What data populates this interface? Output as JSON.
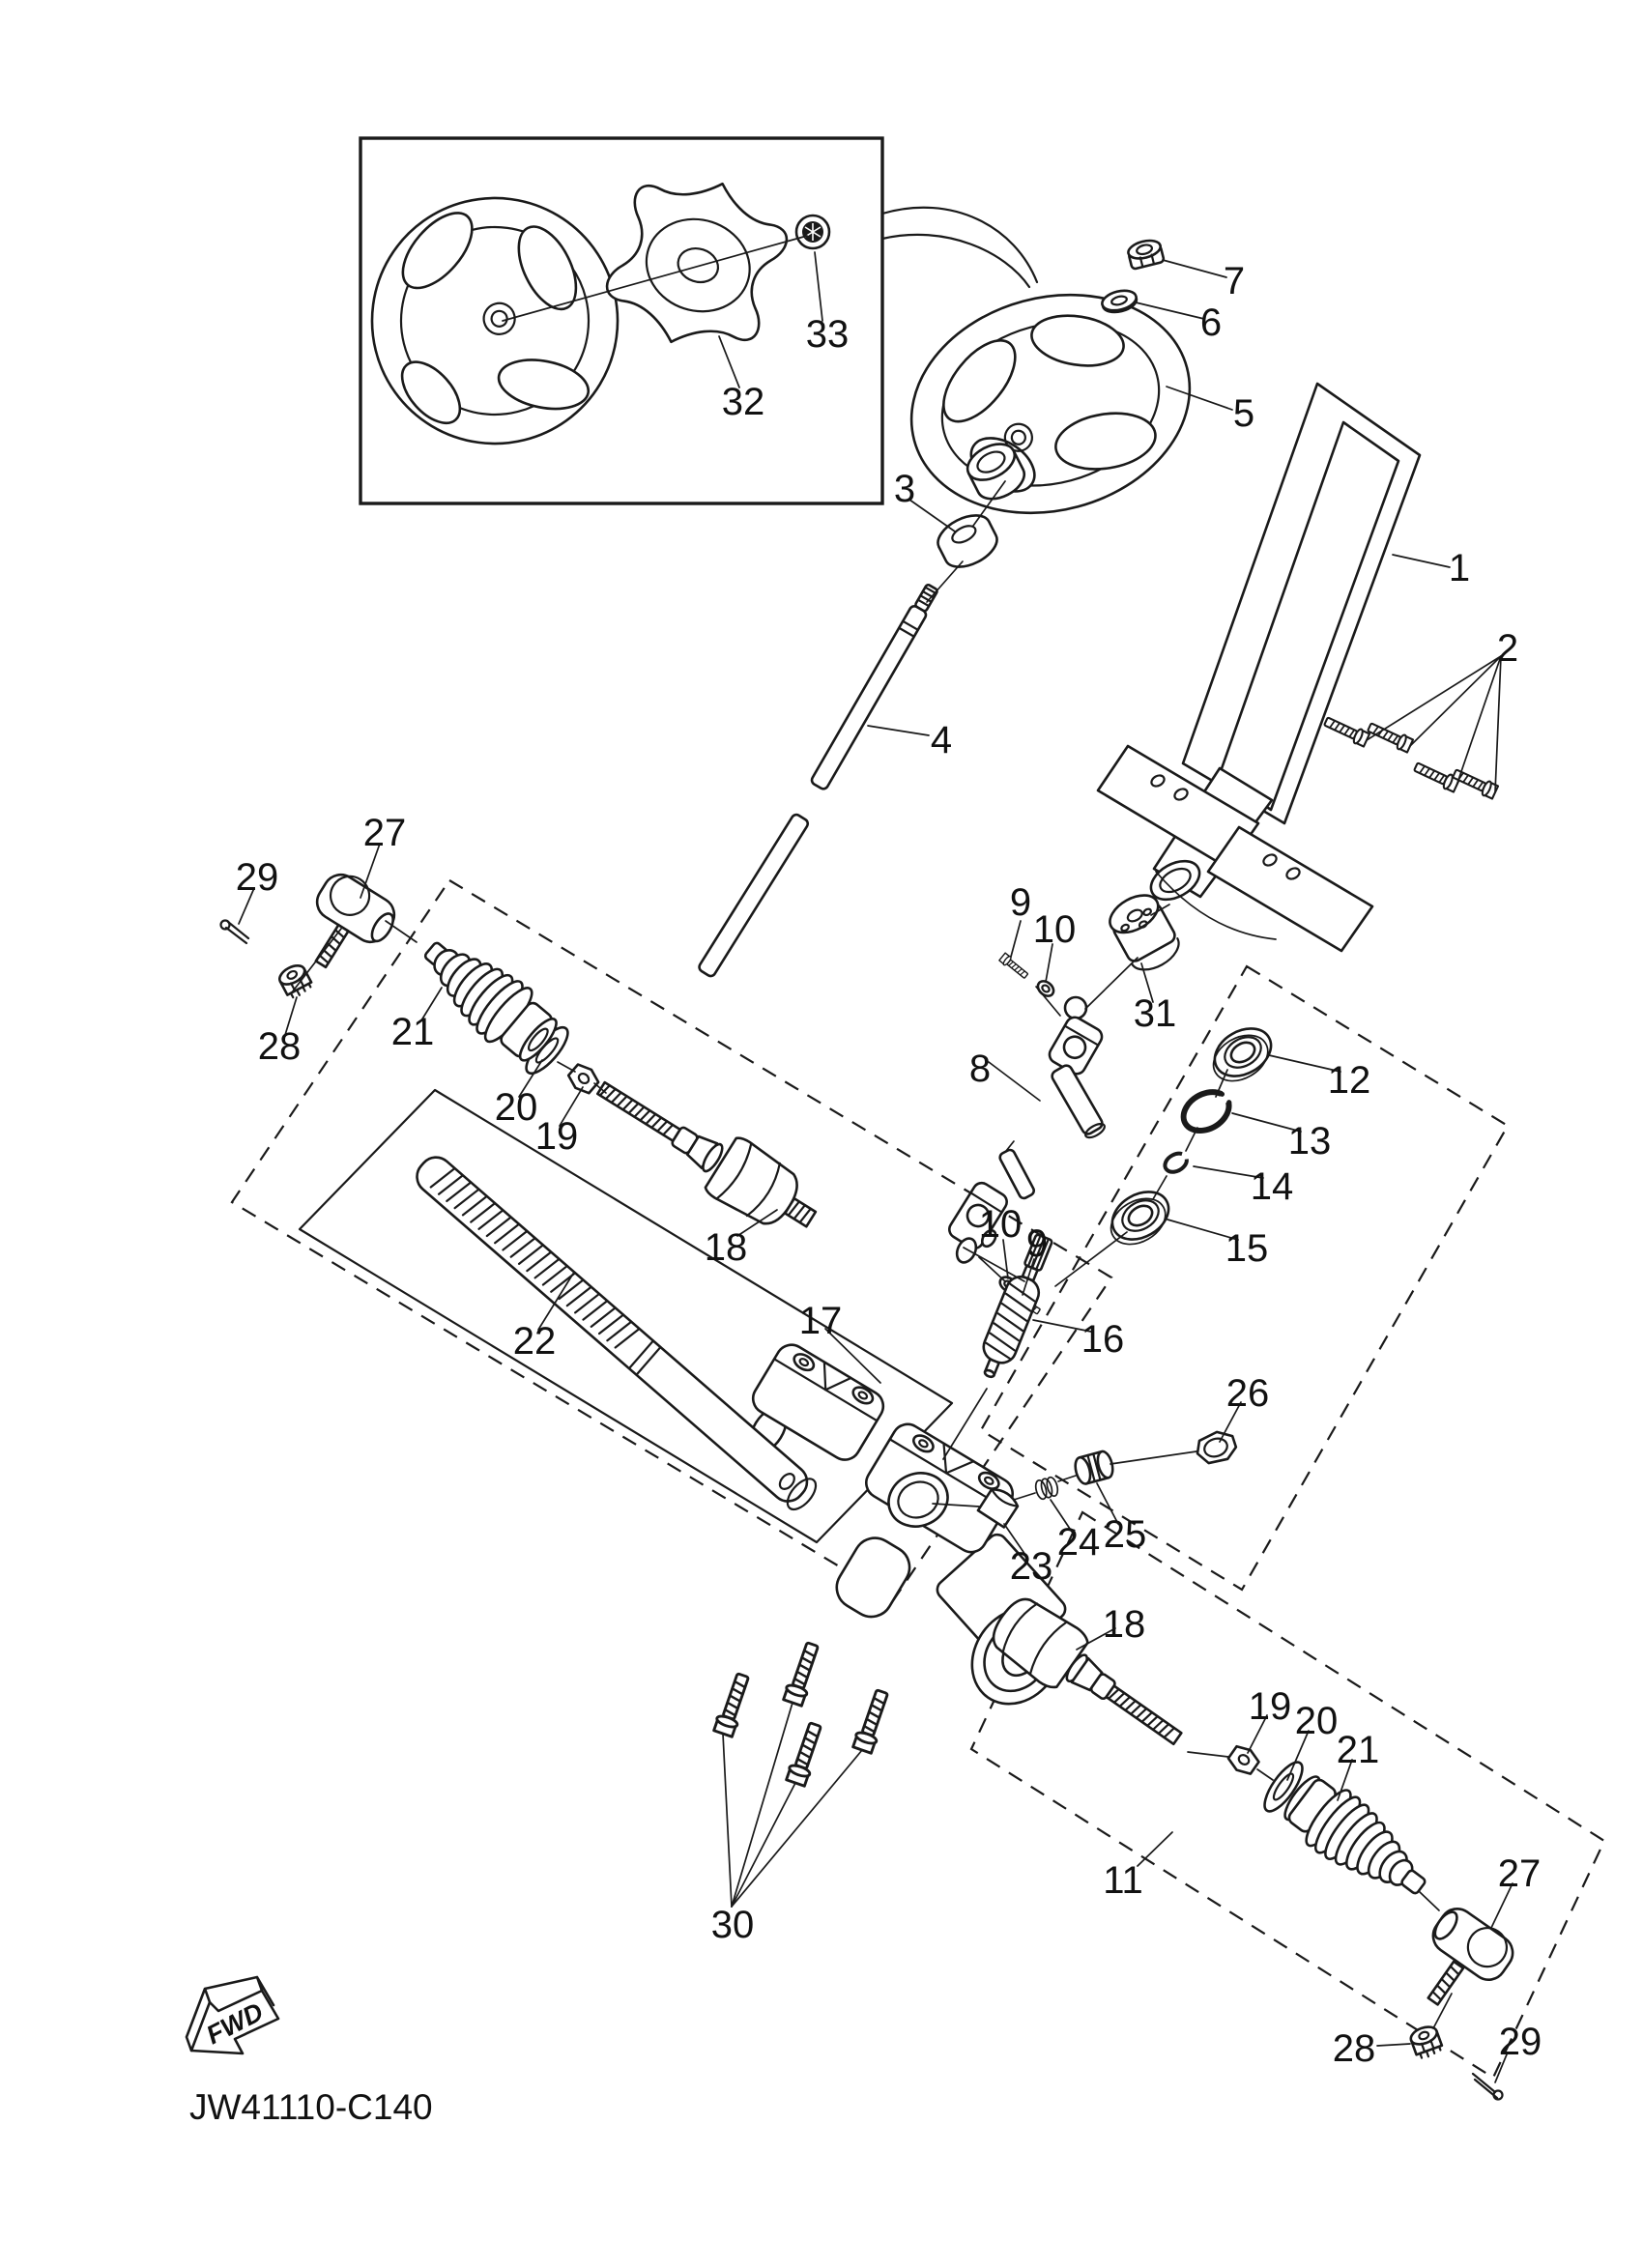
{
  "document": {
    "code": "JW41110-C140",
    "fwd_label": "FWD"
  },
  "colors": {
    "ink": "#1a1a1a",
    "background": "#ffffff"
  },
  "callouts": {
    "c1": "1",
    "c2": "2",
    "c3": "3",
    "c4": "4",
    "c5": "5",
    "c6": "6",
    "c7": "7",
    "c8": "8",
    "c9a": "9",
    "c9b": "9",
    "c10a": "10",
    "c10b": "10",
    "c11": "11",
    "c12": "12",
    "c13": "13",
    "c14": "14",
    "c15": "15",
    "c16": "16",
    "c17": "17",
    "c18a": "18",
    "c18b": "18",
    "c19a": "19",
    "c19b": "19",
    "c20a": "20",
    "c20b": "20",
    "c21a": "21",
    "c21b": "21",
    "c22": "22",
    "c23": "23",
    "c24": "24",
    "c25": "25",
    "c26": "26",
    "c27a": "27",
    "c27b": "27",
    "c28a": "28",
    "c28b": "28",
    "c29a": "29",
    "c29b": "29",
    "c30": "30",
    "c31": "31",
    "c32": "32",
    "c33": "33"
  }
}
